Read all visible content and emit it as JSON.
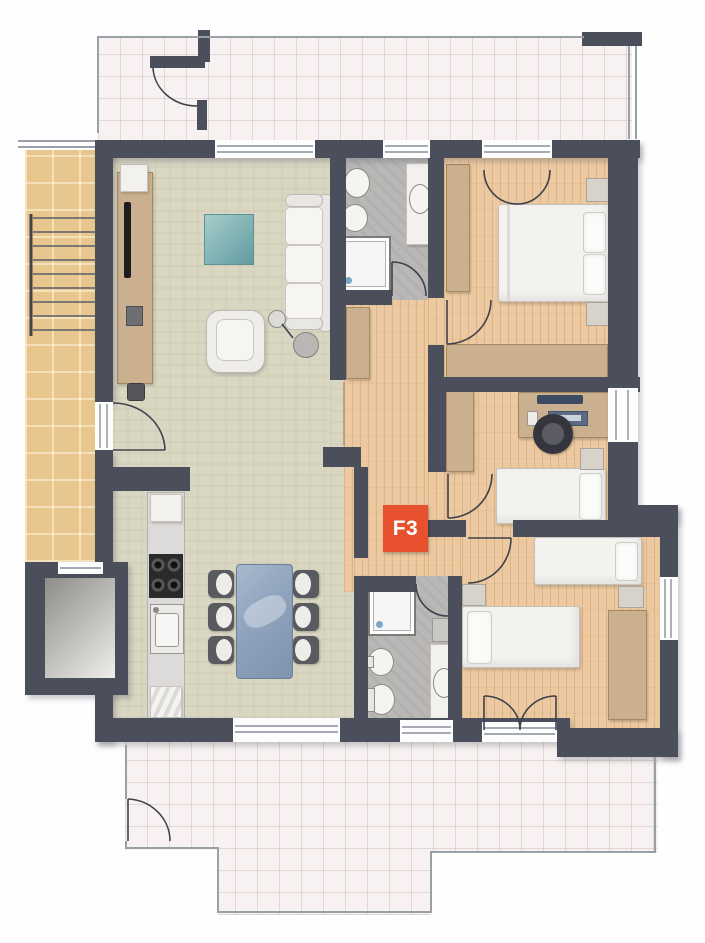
{
  "unit_label": {
    "text": "F3",
    "bg": "#e8512d",
    "fg": "#ffffff"
  },
  "colors": {
    "wall": "#4b4f5b",
    "wood_floor": "#ecc9a0",
    "living_floor": "#d9d6c2",
    "bath_floor": "#bab8b6",
    "terrace_tile": "#f7f2f1",
    "stair_tile": "#e8c78f",
    "wardrobe_wood": "#cbb08f",
    "accent": "#e8512d"
  },
  "rooms": {
    "living_dining_kitchen": {
      "furniture": [
        "tv-sideboard",
        "coffee-table",
        "sofa",
        "armchair",
        "floor-lamp",
        "side-table",
        "dining-table",
        "dining-chairs-x6",
        "kitchen-counter",
        "cooktop",
        "kitchen-sink",
        "fridge"
      ]
    },
    "bedroom_double": {
      "furniture": [
        "double-bed",
        "pillow-x2",
        "nightstand-x2",
        "wardrobe-tall",
        "wardrobe-long"
      ]
    },
    "bedroom_single": {
      "furniture": [
        "single-bed",
        "pillow",
        "desk",
        "monitor",
        "laptop",
        "office-chair",
        "wardrobe",
        "nightstand"
      ]
    },
    "bedroom_twin": {
      "furniture": [
        "single-bed-x2",
        "pillow-x2",
        "nightstand-x2",
        "wardrobe"
      ]
    },
    "bathroom_main": {
      "fixtures": [
        "toilet",
        "bidet",
        "shower",
        "washbasin-vanity"
      ]
    },
    "bathroom_second": {
      "fixtures": [
        "toilet",
        "bidet",
        "shower",
        "washbasin-vanity",
        "wall-cabinet"
      ]
    },
    "hallway": {
      "furniture": [
        "cabinet"
      ]
    },
    "common_areas": [
      "staircase",
      "elevator",
      "terrace-top",
      "terrace-bottom"
    ]
  }
}
